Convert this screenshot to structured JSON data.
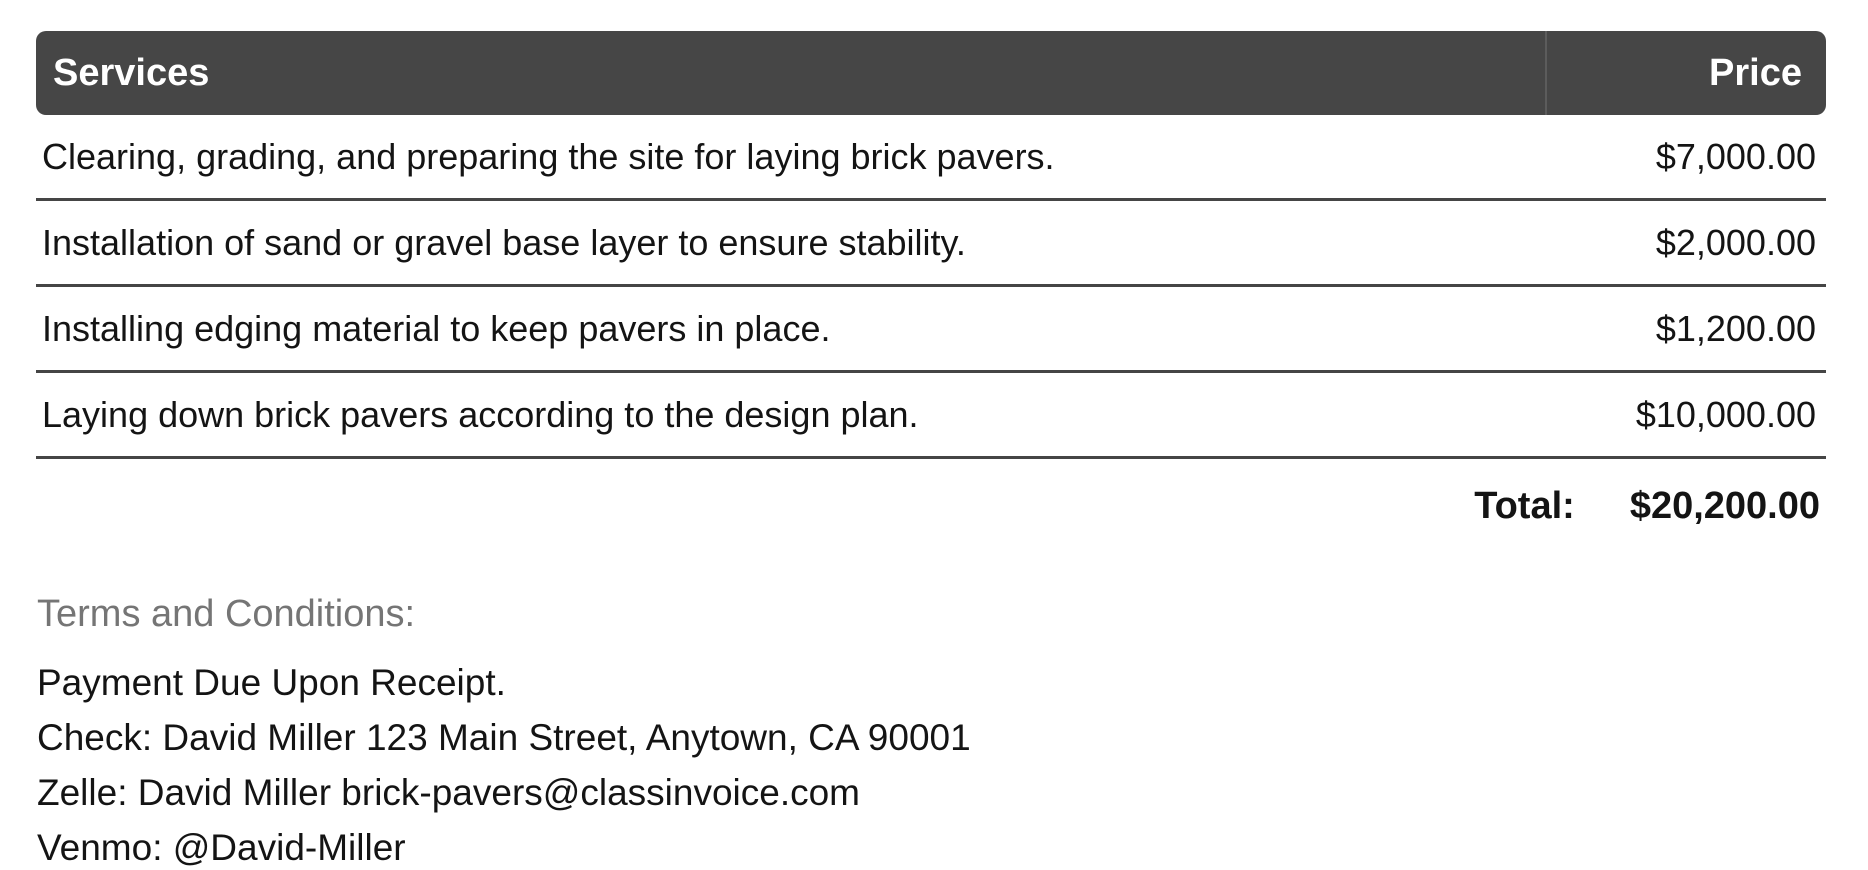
{
  "table": {
    "header": {
      "services_label": "Services",
      "price_label": "Price"
    },
    "rows": [
      {
        "service": "Clearing, grading, and preparing the site for laying brick pavers.",
        "price": "$7,000.00"
      },
      {
        "service": "Installation of sand or gravel base layer to ensure stability.",
        "price": "$2,000.00"
      },
      {
        "service": "Installing edging material to keep pavers in place.",
        "price": "$1,200.00"
      },
      {
        "service": "Laying down brick pavers according to the design plan.",
        "price": "$10,000.00"
      }
    ],
    "total": {
      "label": "Total:",
      "value": "$20,200.00"
    }
  },
  "terms": {
    "heading": "Terms and Conditions:",
    "lines": [
      "Payment Due Upon Receipt.",
      "Check: David Miller 123 Main Street, Anytown, CA 90001",
      "Zelle: David Miller brick-pavers@classinvoice.com",
      "Venmo: @David-Miller"
    ]
  },
  "colors": {
    "header_background": "#464646",
    "header_text": "#ffffff",
    "header_divider": "#5c5c5c",
    "row_separator": "#454545",
    "body_text": "#141414",
    "terms_heading_text": "#757575"
  }
}
